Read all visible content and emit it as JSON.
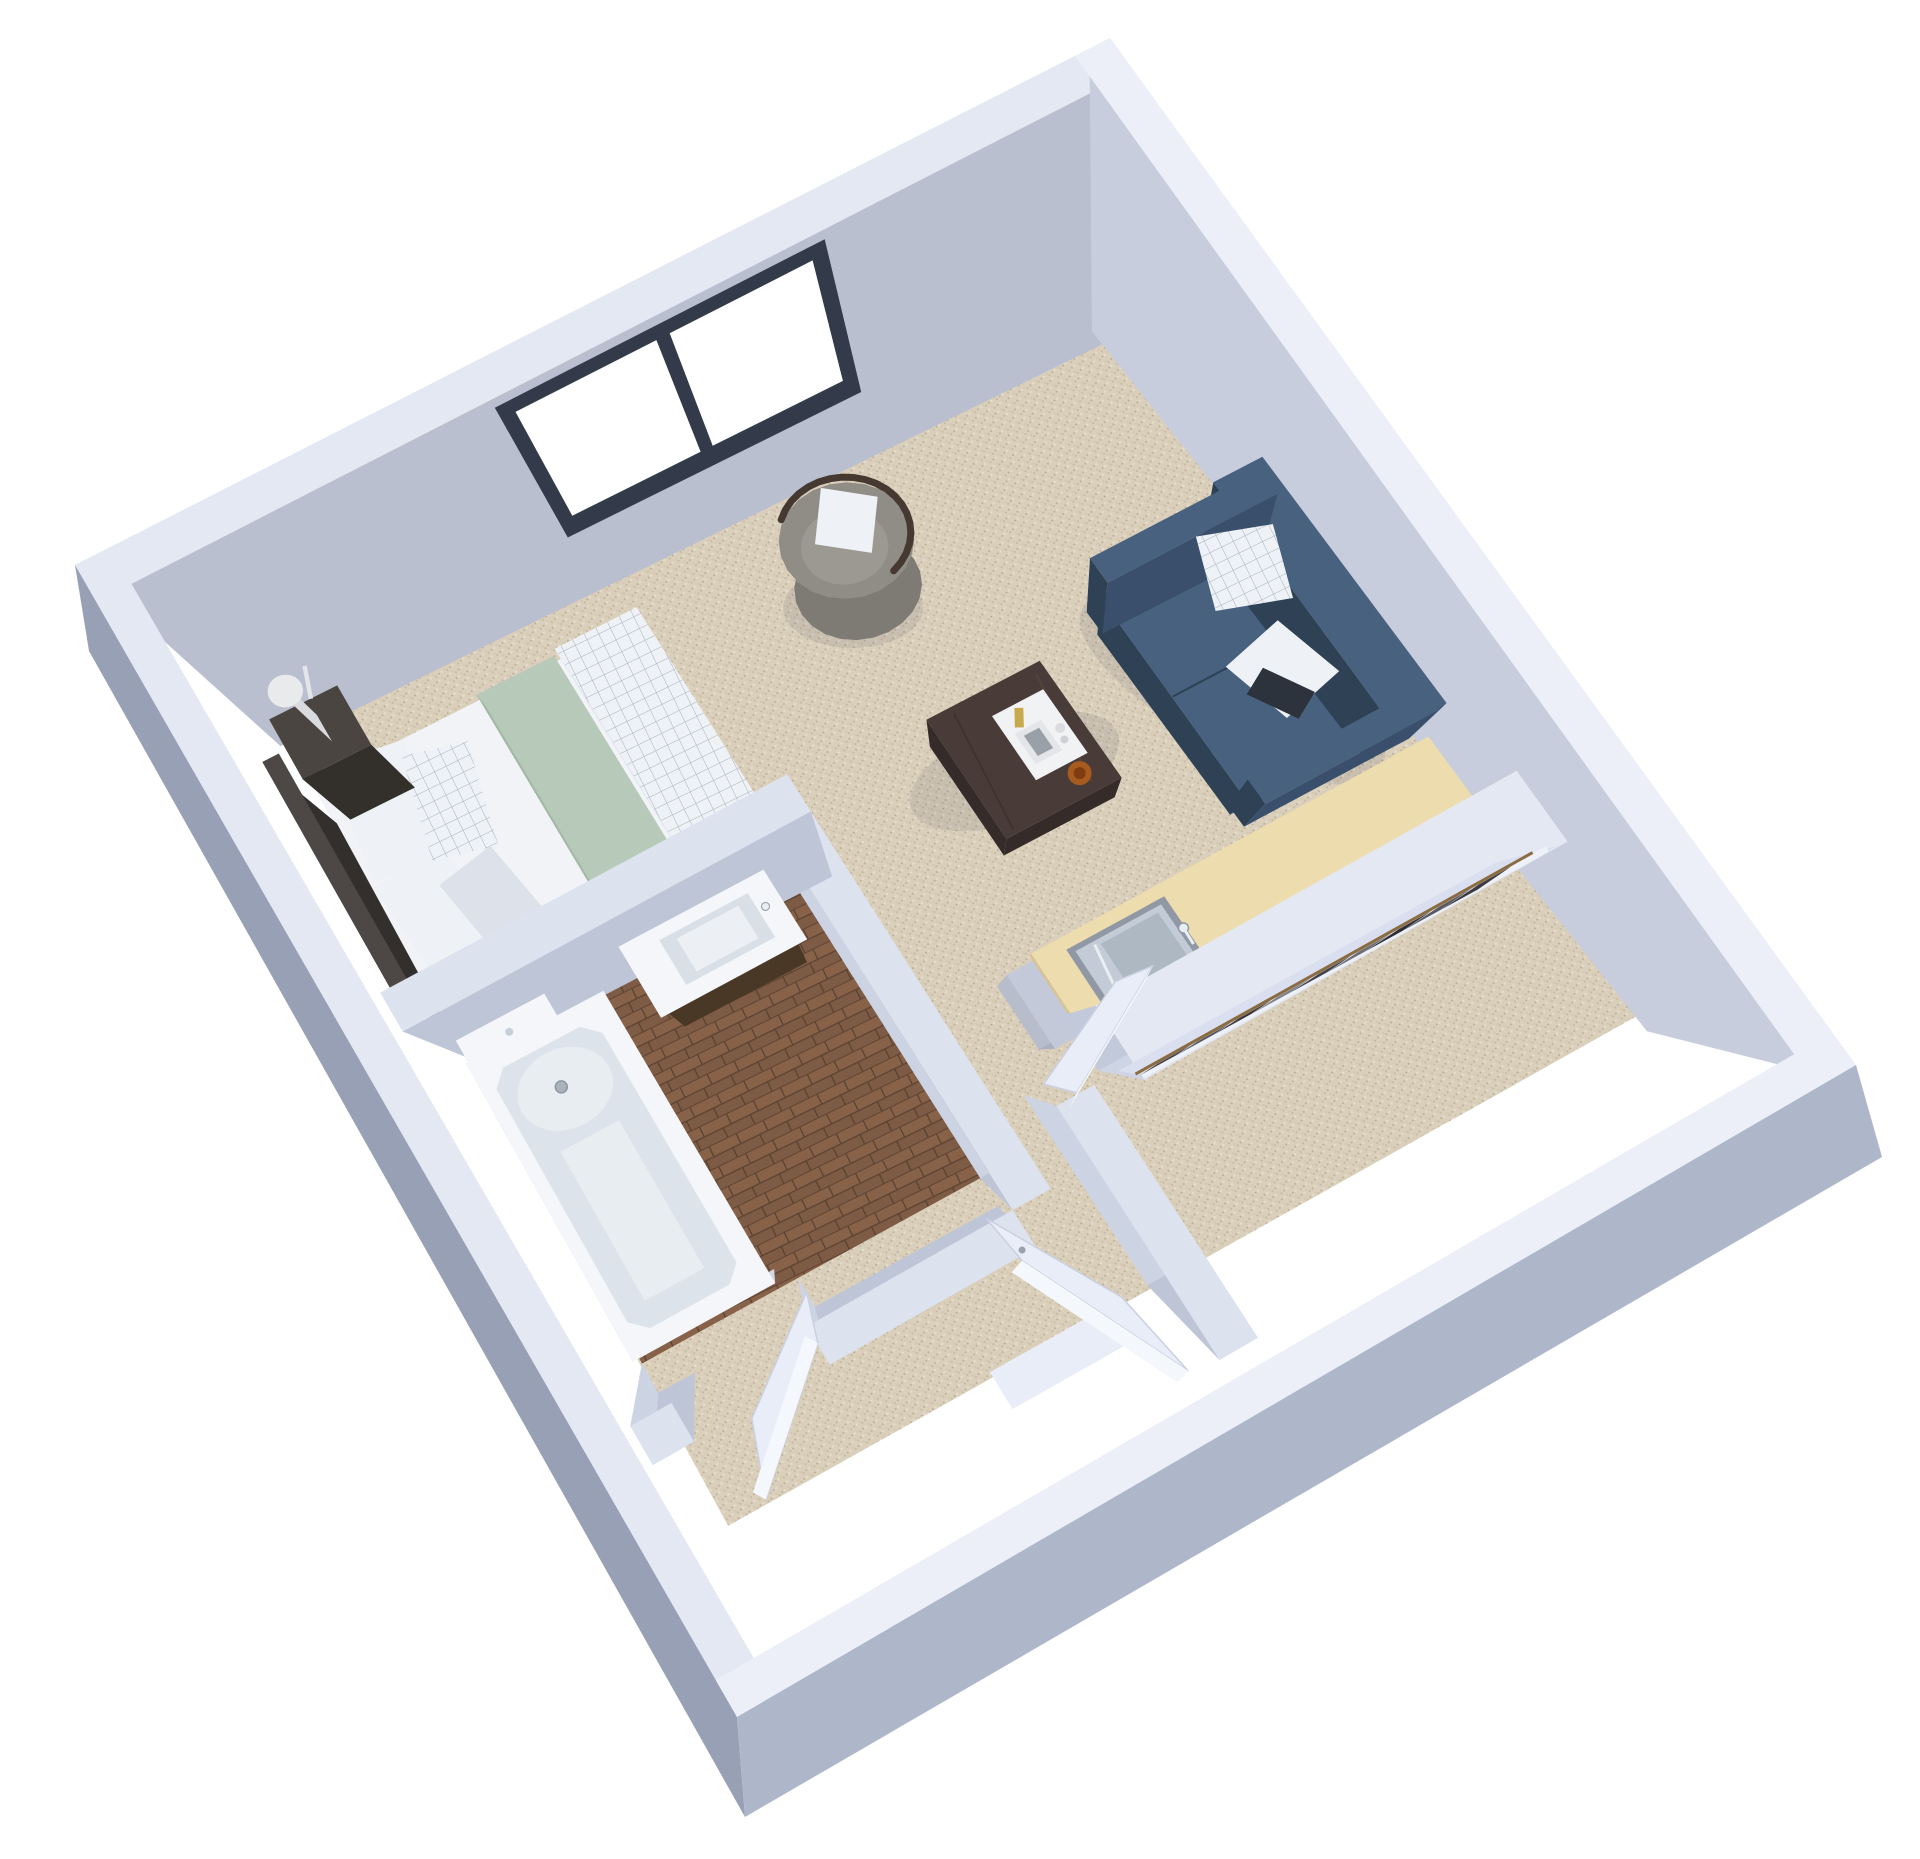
{
  "scene": {
    "kind": "3d-floorplan-render",
    "background": "#ffffff",
    "rooms": [
      "bedroom-area",
      "living-area",
      "kitchenette",
      "bathroom",
      "walk-in-closet",
      "entry-corridor"
    ],
    "furniture": [
      "bed",
      "nightstand",
      "table-lamp",
      "armchair",
      "sofa",
      "coffee-table",
      "decor-tray",
      "kitchen-counter",
      "kitchen-sink",
      "wardrobe",
      "hanging-clothes",
      "bathroom-vanity",
      "toilet",
      "bathtub",
      "window",
      "bathroom-door",
      "closet-door",
      "entry-door"
    ]
  },
  "palette": {
    "bg": "#ffffff",
    "wallTop": "#e3e8f3",
    "wallTopLight": "#eceff8",
    "wallInnerNW": "#b9bfce",
    "wallInnerNE": "#c7cddc",
    "wallOuterSW": "#97a0b5",
    "wallOuterSE": "#aeb6ca",
    "intWallTop": "#dde2ef",
    "intWallU": "#bec5d7",
    "intWallV": "#ccd3e3",
    "carpet": "#dacfbb",
    "carpetDot1": "#c4b79f",
    "carpetDot2": "#e7dfcd",
    "carpetDot3": "#b5a78e",
    "wood": "#7e5b45",
    "woodLight": "#8a6750",
    "woodDark": "#5f4433",
    "counterWood": "#ecdcae",
    "counterEdge": "#d9c391",
    "steel": "#c3ccd6",
    "steelDark": "#8f98a4",
    "steelLight": "#e9eef3",
    "sofaTop": "#47617f",
    "sofaSide": "#394f6b",
    "sofaDark": "#2e4155",
    "chairBody": "#908c86",
    "chairTrim": "#463931",
    "chairCushion": "#9c9892",
    "tableTop": "#493c38",
    "tableSide": "#352c29",
    "chrome": "#c6cacf",
    "tray": "#f1f2f4",
    "gold": "#c8a94e",
    "amber": "#a85b1f",
    "amberDark": "#7d3c12",
    "duvet": "#f1f3f7",
    "duvetShadow": "#dde2ea",
    "duvetSide": "#e6eaf1",
    "sage": "#b7c9b8",
    "sageDark": "#a3b8a5",
    "pillow": "#eef1f5",
    "gridLine": "#a7b1bb",
    "headboard": "#4d4845",
    "darkFurn": "#3a3530",
    "nightstand": "#4a4540",
    "white": "#f4f6f9",
    "toiletShadow": "#d7dde4",
    "tubInner": "#dde3ea",
    "tubFloor": "#e8edf2",
    "door": "#e9edf7",
    "doorEdge": "#c9d0e1",
    "windowFrame": "#333a4a",
    "glass": "#ffffff",
    "shadow": "rgba(60,60,80,0.10)",
    "rod": "#8a6b42",
    "clothes": [
      "#3b3b41",
      "#5a5a61",
      "#2e2e34",
      "#6e6e76",
      "#42424a",
      "#808089",
      "#35353b",
      "#55555e",
      "#47474f"
    ]
  }
}
